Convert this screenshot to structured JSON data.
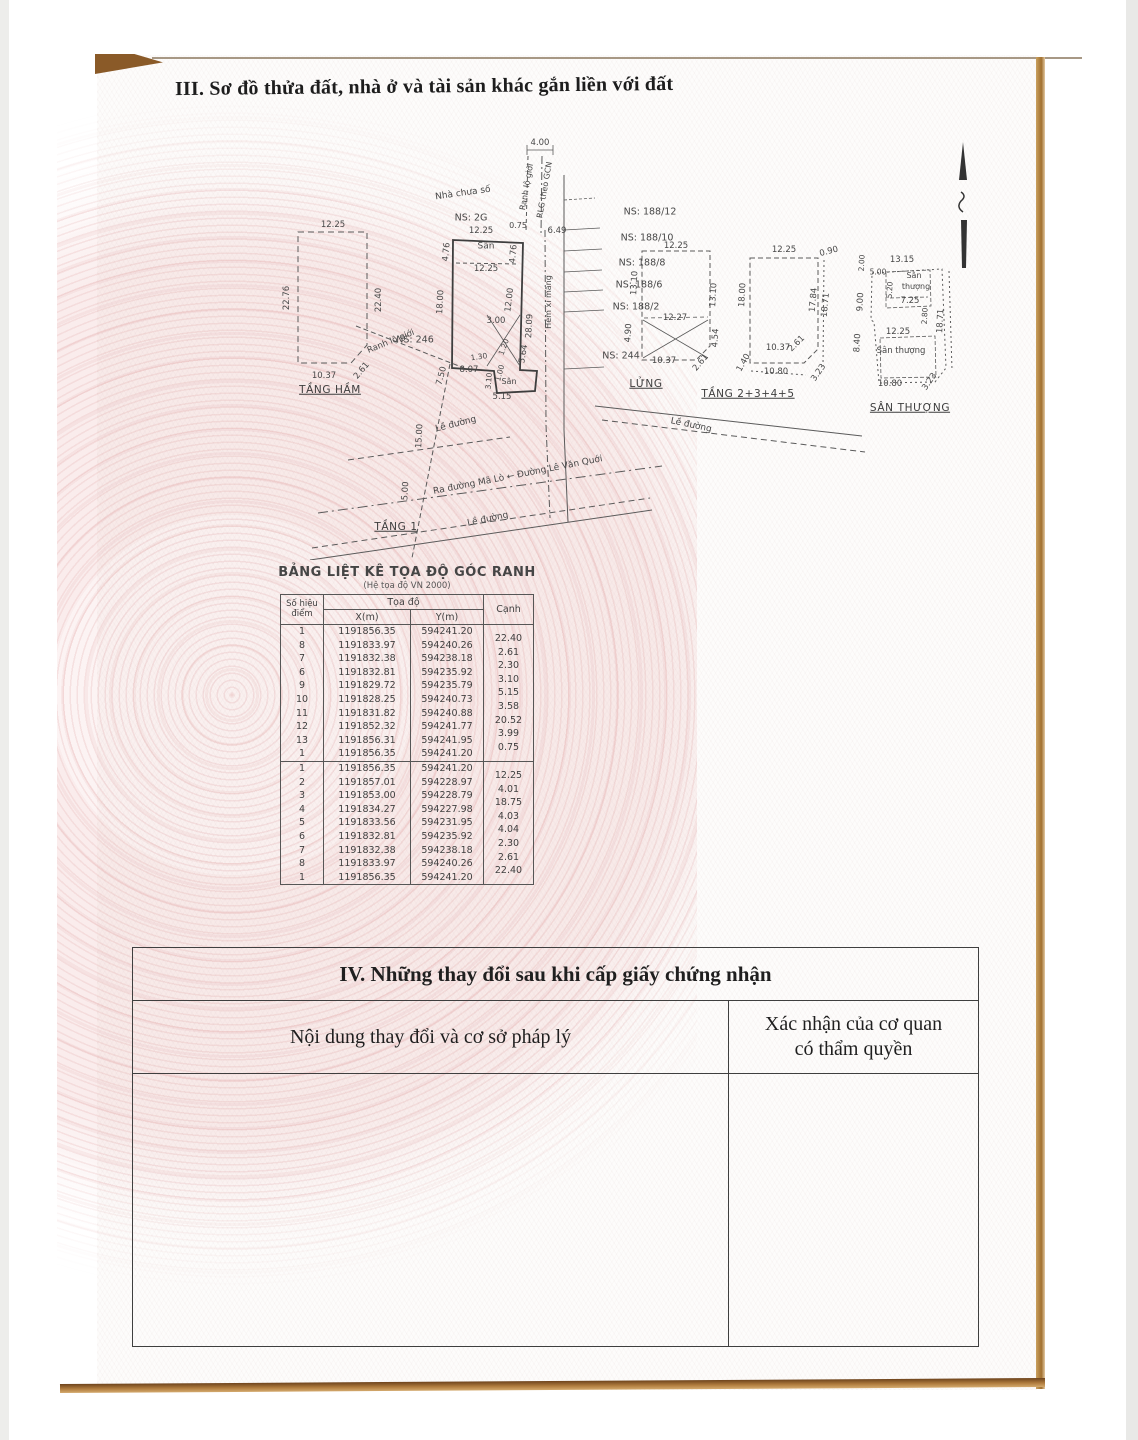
{
  "document": {
    "section3_title": "III. Sơ đồ thửa đất, nhà ở và tài sản khác gắn liền với đất",
    "section4": {
      "title": "IV. Những thay đổi sau khi cấp giấy chứng nhận",
      "col1_header": "Nội dung thay đổi và cơ sở pháp lý",
      "col2_header_line1": "Xác nhận của cơ quan",
      "col2_header_line2": "có thẩm quyền"
    }
  },
  "coord_table": {
    "title": "BẢNG LIỆT KÊ TỌA ĐỘ GÓC RANH",
    "subtitle": "(Hệ tọa độ VN 2000)",
    "headers": {
      "point": "Số hiệu điểm",
      "coords": "Tọa độ",
      "x": "X(m)",
      "y": "Y(m)",
      "edge": "Cạnh"
    },
    "blocks": [
      {
        "rows": [
          {
            "p": "1",
            "x": "1191856.35",
            "y": "594241.20",
            "c": "22.40"
          },
          {
            "p": "8",
            "x": "1191833.97",
            "y": "594240.26",
            "c": "2.61"
          },
          {
            "p": "7",
            "x": "1191832.38",
            "y": "594238.18",
            "c": "2.30"
          },
          {
            "p": "6",
            "x": "1191832.81",
            "y": "594235.92",
            "c": "3.10"
          },
          {
            "p": "9",
            "x": "1191829.72",
            "y": "594235.79",
            "c": "5.15"
          },
          {
            "p": "10",
            "x": "1191828.25",
            "y": "594240.73",
            "c": "3.58"
          },
          {
            "p": "11",
            "x": "1191831.82",
            "y": "594240.88",
            "c": "20.52"
          },
          {
            "p": "12",
            "x": "1191852.32",
            "y": "594241.77",
            "c": "3.99"
          },
          {
            "p": "13",
            "x": "1191856.31",
            "y": "594241.95",
            "c": "0.75"
          },
          {
            "p": "1",
            "x": "1191856.35",
            "y": "594241.20",
            "c": ""
          }
        ]
      },
      {
        "rows": [
          {
            "p": "1",
            "x": "1191856.35",
            "y": "594241.20",
            "c": "12.25"
          },
          {
            "p": "2",
            "x": "1191857.01",
            "y": "594228.97",
            "c": "4.01"
          },
          {
            "p": "3",
            "x": "1191853.00",
            "y": "594228.79",
            "c": "18.75"
          },
          {
            "p": "4",
            "x": "1191834.27",
            "y": "594227.98",
            "c": "4.03"
          },
          {
            "p": "5",
            "x": "1191833.56",
            "y": "594231.95",
            "c": "4.04"
          },
          {
            "p": "6",
            "x": "1191832.81",
            "y": "594235.92",
            "c": "2.30"
          },
          {
            "p": "7",
            "x": "1191832.38",
            "y": "594238.18",
            "c": "2.61"
          },
          {
            "p": "8",
            "x": "1191833.97",
            "y": "594240.26",
            "c": "22.40"
          },
          {
            "p": "1",
            "x": "1191856.35",
            "y": "594241.20",
            "c": ""
          }
        ]
      }
    ]
  },
  "diagram": {
    "annotations": [
      {
        "t": "12.25",
        "x": 243,
        "y": 95
      },
      {
        "t": "22.76",
        "x": 197,
        "y": 168,
        "r": -90
      },
      {
        "t": "22.40",
        "x": 289,
        "y": 170,
        "r": -90
      },
      {
        "t": "10.37",
        "x": 234,
        "y": 246
      },
      {
        "t": "2.61",
        "x": 272,
        "y": 241,
        "r": -50
      },
      {
        "t": "TẦNG HẦM",
        "x": 240,
        "y": 260,
        "s": 10.5,
        "u": 1,
        "n": "floor-label-tang-ham"
      },
      {
        "t": "4.00",
        "x": 450,
        "y": 13
      },
      {
        "t": "Nhà chưa số",
        "x": 373,
        "y": 64,
        "r": -8,
        "s": 9,
        "n": "neighbor-lot-label"
      },
      {
        "t": "Ranh lộ giới",
        "x": 437,
        "y": 57,
        "r": -80,
        "s": 8,
        "n": "boundary-label"
      },
      {
        "t": "RLG theo GCN",
        "x": 455,
        "y": 60,
        "r": -80,
        "s": 8,
        "n": "boundary-label"
      },
      {
        "t": "NS: 2G",
        "x": 381,
        "y": 88,
        "s": 9.5,
        "n": "neighbor-lot-label"
      },
      {
        "t": "0.75",
        "x": 428,
        "y": 96,
        "s": 8
      },
      {
        "t": "12.25",
        "x": 391,
        "y": 101
      },
      {
        "t": "6.49",
        "x": 467,
        "y": 101
      },
      {
        "t": "Sân",
        "x": 396,
        "y": 117,
        "s": 9
      },
      {
        "t": "4.76",
        "x": 357,
        "y": 122,
        "r": -85
      },
      {
        "t": "4.76",
        "x": 424,
        "y": 124,
        "r": -85
      },
      {
        "t": "12.25",
        "x": 396,
        "y": 139
      },
      {
        "t": "NS: 246",
        "x": 325,
        "y": 210,
        "s": 9.5,
        "n": "neighbor-lot-label"
      },
      {
        "t": "18.00",
        "x": 351,
        "y": 172,
        "r": -87
      },
      {
        "t": "12.00",
        "x": 420,
        "y": 170,
        "r": -83
      },
      {
        "t": "28.09",
        "x": 440,
        "y": 196,
        "r": -87
      },
      {
        "t": "5.64",
        "x": 434,
        "y": 224,
        "r": -80
      },
      {
        "t": "Hẻm xi măng",
        "x": 459,
        "y": 172,
        "r": -90,
        "s": 8,
        "n": "alley-label"
      },
      {
        "t": "3.00",
        "x": 406,
        "y": 191
      },
      {
        "t": "1.20",
        "x": 414,
        "y": 217,
        "r": -70,
        "s": 7.5
      },
      {
        "t": "1.30",
        "x": 389,
        "y": 227,
        "r": -8,
        "s": 7.5
      },
      {
        "t": "8.07",
        "x": 379,
        "y": 240
      },
      {
        "t": "3.10",
        "x": 399,
        "y": 251,
        "r": -85,
        "s": 7.5
      },
      {
        "t": "1.00",
        "x": 410,
        "y": 243,
        "r": -75,
        "s": 7.5
      },
      {
        "t": "Sân",
        "x": 419,
        "y": 252,
        "s": 8
      },
      {
        "t": "5.15",
        "x": 412,
        "y": 267
      },
      {
        "t": "Ranh lộ giới",
        "x": 301,
        "y": 212,
        "r": -22,
        "s": 8.5,
        "n": "boundary-label"
      },
      {
        "t": "7.50",
        "x": 352,
        "y": 246,
        "r": -75
      },
      {
        "t": "Lề đường",
        "x": 366,
        "y": 295,
        "r": -14,
        "s": 9,
        "n": "sidewalk-label"
      },
      {
        "t": "Lề đường",
        "x": 601,
        "y": 296,
        "r": 12,
        "s": 9,
        "n": "sidewalk-label"
      },
      {
        "t": "15.00",
        "x": 330,
        "y": 306,
        "r": -87
      },
      {
        "t": "Ra đường Mã Lò ← Đường Lê Văn Quới",
        "x": 428,
        "y": 346,
        "r": -11,
        "s": 9,
        "n": "road-label"
      },
      {
        "t": "5.00",
        "x": 316,
        "y": 361,
        "r": -87
      },
      {
        "t": "Lề đường",
        "x": 398,
        "y": 390,
        "r": -12,
        "s": 9,
        "n": "sidewalk-label"
      },
      {
        "t": "TẦNG 1",
        "x": 306,
        "y": 397,
        "s": 10.5,
        "u": 1,
        "n": "floor-label-tang-1"
      },
      {
        "t": "NS: 188/12",
        "x": 560,
        "y": 82,
        "s": 9.5,
        "n": "neighbor-lot-label"
      },
      {
        "t": "NS: 188/10",
        "x": 557,
        "y": 108,
        "s": 9.5,
        "n": "neighbor-lot-label"
      },
      {
        "t": "NS: 188/8",
        "x": 552,
        "y": 133,
        "s": 9.5,
        "n": "neighbor-lot-label"
      },
      {
        "t": "NS: 188/6",
        "x": 549,
        "y": 155,
        "s": 9.5,
        "n": "neighbor-lot-label"
      },
      {
        "t": "NS: 188/2",
        "x": 546,
        "y": 177,
        "s": 9.5,
        "n": "neighbor-lot-label"
      },
      {
        "t": "NS: 244",
        "x": 531,
        "y": 226,
        "s": 9.5,
        "n": "neighbor-lot-label"
      },
      {
        "t": "12.25",
        "x": 586,
        "y": 116
      },
      {
        "t": "13.10",
        "x": 545,
        "y": 153,
        "r": -87
      },
      {
        "t": "13.10",
        "x": 624,
        "y": 165,
        "r": -87
      },
      {
        "t": "12.27",
        "x": 585,
        "y": 188
      },
      {
        "t": "4.90",
        "x": 539,
        "y": 203,
        "r": -87
      },
      {
        "t": "4.54",
        "x": 626,
        "y": 208,
        "r": -87
      },
      {
        "t": "10.37",
        "x": 574,
        "y": 231
      },
      {
        "t": "2.61",
        "x": 611,
        "y": 233,
        "r": -50
      },
      {
        "t": "LỬNG",
        "x": 556,
        "y": 254,
        "s": 10.5,
        "u": 1,
        "n": "floor-label-lung"
      },
      {
        "t": "12.25",
        "x": 694,
        "y": 120
      },
      {
        "t": "0.90",
        "x": 739,
        "y": 122,
        "r": -15
      },
      {
        "t": "18.00",
        "x": 653,
        "y": 165,
        "r": -87
      },
      {
        "t": "17.84",
        "x": 724,
        "y": 170,
        "r": -85
      },
      {
        "t": "18.71",
        "x": 736,
        "y": 175,
        "r": -85
      },
      {
        "t": "10.37",
        "x": 688,
        "y": 218
      },
      {
        "t": "2.61",
        "x": 707,
        "y": 214,
        "r": -45
      },
      {
        "t": "1.40",
        "x": 654,
        "y": 233,
        "r": -60
      },
      {
        "t": "10.80",
        "x": 686,
        "y": 242
      },
      {
        "t": "3.23",
        "x": 729,
        "y": 243,
        "r": -55
      },
      {
        "t": "TẦNG 2+3+4+5",
        "x": 658,
        "y": 264,
        "s": 10.5,
        "u": 1,
        "n": "floor-label-tang-2345"
      },
      {
        "t": "2.00",
        "x": 772,
        "y": 133,
        "r": -87,
        "s": 7.5
      },
      {
        "t": "13.15",
        "x": 812,
        "y": 130
      },
      {
        "t": "5.00",
        "x": 788,
        "y": 142,
        "s": 7.5
      },
      {
        "t": "Sân",
        "x": 824,
        "y": 146,
        "s": 8
      },
      {
        "t": "thượng",
        "x": 826,
        "y": 157,
        "s": 8
      },
      {
        "t": "5.20",
        "x": 800,
        "y": 160,
        "r": -87,
        "s": 7.5
      },
      {
        "t": "7.25",
        "x": 820,
        "y": 171
      },
      {
        "t": "9.00",
        "x": 771,
        "y": 172,
        "r": -87
      },
      {
        "t": "2.80",
        "x": 835,
        "y": 186,
        "r": -87,
        "s": 7.5
      },
      {
        "t": "18.71",
        "x": 851,
        "y": 191,
        "r": -87
      },
      {
        "t": "12.25",
        "x": 808,
        "y": 202
      },
      {
        "t": "8.40",
        "x": 768,
        "y": 213,
        "r": -87
      },
      {
        "t": "Sân thượng",
        "x": 811,
        "y": 221,
        "s": 8.5
      },
      {
        "t": "10.80",
        "x": 800,
        "y": 254
      },
      {
        "t": "3.23",
        "x": 840,
        "y": 252,
        "r": -55
      },
      {
        "t": "SÂN THƯỢNG",
        "x": 820,
        "y": 278,
        "s": 10.5,
        "u": 1,
        "n": "floor-label-san-thuong"
      }
    ]
  }
}
